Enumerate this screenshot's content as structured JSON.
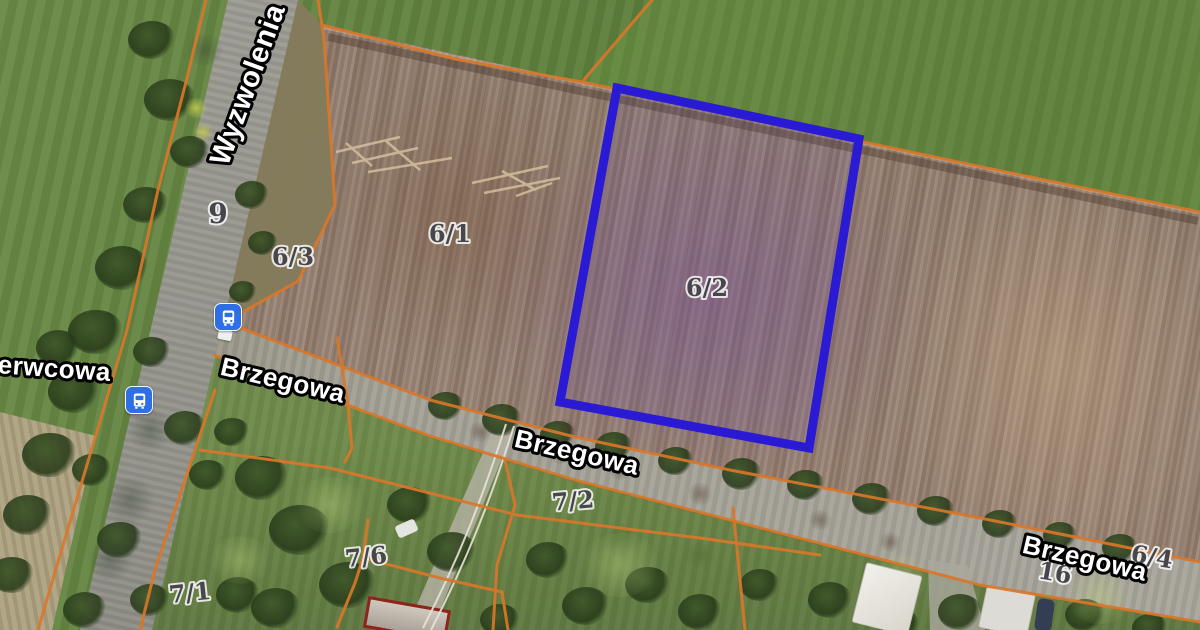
{
  "map_type": "satellite-cadastral",
  "streets": {
    "wyzwolenia": "Wyzwolenia",
    "czerwcowa": "Czerwcowa",
    "brzegowa": "Brzegowa"
  },
  "parcels": {
    "p9": "9",
    "p6_1": "6/1",
    "p6_2": "6/2",
    "p6_3": "6/3",
    "p6_4": "6/4",
    "p7_1": "7/1",
    "p7_2": "7/2",
    "p7_6": "7/6",
    "p16": "16"
  },
  "highlight": {
    "parcel": "6/2",
    "outline_color": "#2b1ad4"
  },
  "cadastral": {
    "line_color": "#d9772a"
  },
  "transit": {
    "icon": "bus-icon",
    "color": "#2e6fe8",
    "stop_count": 2
  }
}
